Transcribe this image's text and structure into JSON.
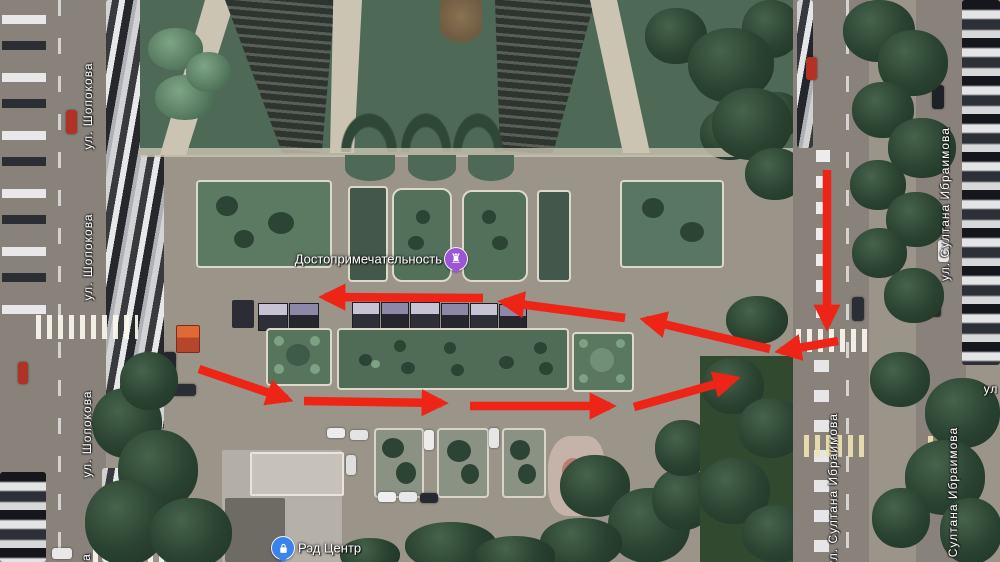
{
  "map": {
    "type": "satellite",
    "street_labels": [
      {
        "text": "ул. Шопокова",
        "x": 88,
        "y": 106,
        "dir": "v"
      },
      {
        "text": "ул. Шопокова",
        "x": 88,
        "y": 257,
        "dir": "v"
      },
      {
        "text": "ул. Шопокова",
        "x": 87,
        "y": 434,
        "dir": "v"
      },
      {
        "text": "а",
        "x": 86,
        "y": 557,
        "dir": "v"
      },
      {
        "text": "ул. Султана Ибраимова",
        "x": 945,
        "y": 204,
        "dir": "v"
      },
      {
        "text": "ул. Султана Ибраимова",
        "x": 833,
        "y": 490,
        "dir": "v"
      },
      {
        "text": "Султана Ибраимова",
        "x": 953,
        "y": 492,
        "dir": "v"
      },
      {
        "text": "ул",
        "x": 991,
        "y": 389,
        "dir": "h"
      }
    ],
    "markers": [
      {
        "id": "attraction",
        "label": "Достопримечательность",
        "x": 456,
        "y": 259,
        "color": "#9b57d3",
        "glyph": "monument-icon",
        "label_side": "left"
      },
      {
        "id": "red-center",
        "label": "Рэд Центр",
        "x": 283,
        "y": 548,
        "color": "#3b82ea",
        "glyph": "shopping-bag-icon",
        "label_side": "right"
      }
    ],
    "route_annotation": {
      "color": "#ee2417",
      "stroke_width": 8.5,
      "segments": [
        {
          "x1": 827,
          "y1": 170,
          "x2": 827,
          "y2": 325
        },
        {
          "x1": 838,
          "y1": 341,
          "x2": 781,
          "y2": 351
        },
        {
          "x1": 770,
          "y1": 349,
          "x2": 646,
          "y2": 320
        },
        {
          "x1": 625,
          "y1": 318,
          "x2": 504,
          "y2": 302
        },
        {
          "x1": 483,
          "y1": 298,
          "x2": 325,
          "y2": 297
        },
        {
          "x1": 199,
          "y1": 369,
          "x2": 287,
          "y2": 399
        },
        {
          "x1": 304,
          "y1": 401,
          "x2": 442,
          "y2": 403
        },
        {
          "x1": 470,
          "y1": 406,
          "x2": 610,
          "y2": 406
        },
        {
          "x1": 634,
          "y1": 407,
          "x2": 734,
          "y2": 379
        }
      ]
    }
  }
}
